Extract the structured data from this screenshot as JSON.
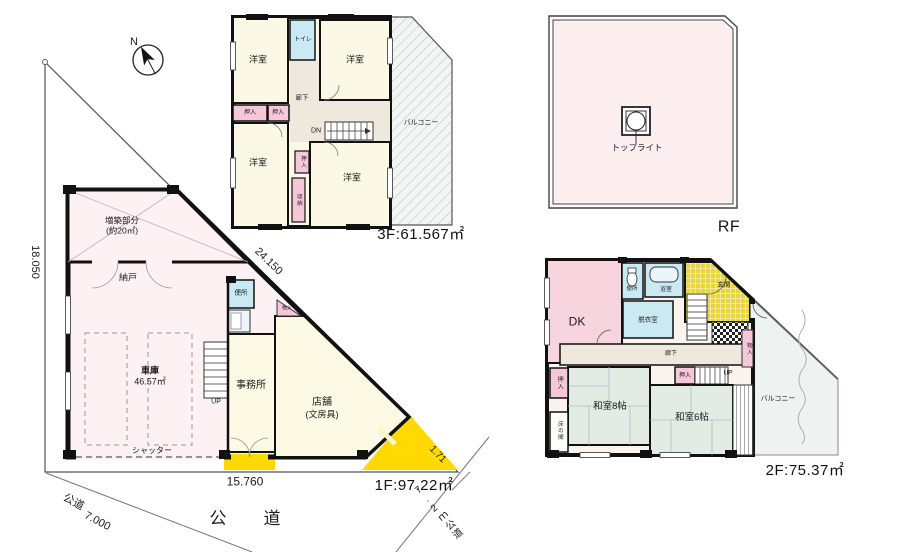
{
  "palette": {
    "road_yellow": "#ffd900",
    "room_cream": "#fbf9e6",
    "plan_pink": "#fdf1f3",
    "dk_pink": "#f8d5de",
    "water_blue": "#c9e9f3",
    "closet_pink": "#f6c7d9",
    "tatami_green": "#e2ece5",
    "corridor_beige": "#efe8dd",
    "roof_pink": "#fdeef0"
  },
  "site": {
    "north_label": "N",
    "dim_left": "18.050",
    "dim_hypotenuse": "24.150",
    "dim_bottom": "15.760",
    "dim_corner": "1.71",
    "road_sw_name": "公道",
    "road_sw_width": "7.000",
    "road_south": "公　道",
    "road_se": "7.2ｍ公道"
  },
  "floor1": {
    "area_label": "1F:97.22㎡",
    "extension_line1": "増築部分",
    "extension_line2": "(約20㎡)",
    "storeroom": "納戸",
    "garage": "車庫",
    "garage_area": "46.57㎡",
    "shutter": "シャッター",
    "toilet": "便所",
    "office": "事務所",
    "shop_line1": "店舗",
    "shop_line2": "(文房具)",
    "closet": "物入",
    "stairs_up": "UP"
  },
  "floor3": {
    "area_label": "3F:61.567㎡",
    "room_nw": "洋室",
    "room_ne": "洋室",
    "room_sw": "洋室",
    "room_se": "洋室",
    "toilet": "トイレ",
    "corridor": "廊下",
    "closet_w1": "押入",
    "closet_w2": "押入",
    "closet_center": "押入",
    "storage": "収納",
    "stairs_dn": "DN",
    "balcony": "バルコニー"
  },
  "roof": {
    "area_label": "RF",
    "toplight": "トップライト"
  },
  "floor2": {
    "area_label": "2F:75.37㎡",
    "dk": "DK",
    "toilet": "便所",
    "bath": "浴室",
    "dressing": "脱衣室",
    "entrance": "玄関",
    "corridor": "廊下",
    "closet_center": "押入",
    "closet_left": "押入",
    "closet_right": "物入",
    "stairs_up": "UP",
    "washitsu8": "和室8帖",
    "washitsu6": "和室6帖",
    "tokonoma": "床の間",
    "balcony": "バルコニー"
  }
}
